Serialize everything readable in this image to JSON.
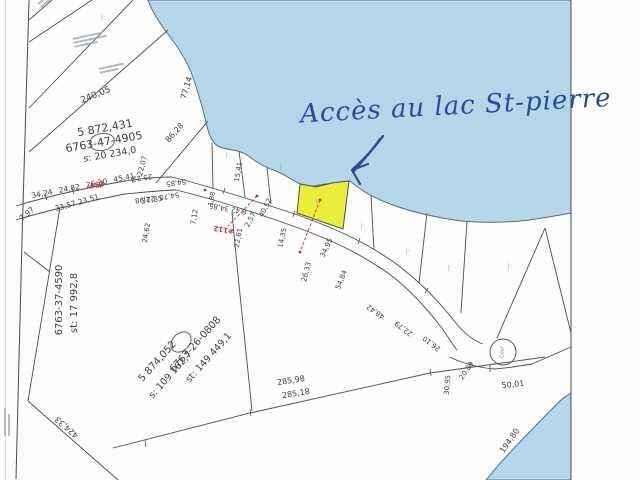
{
  "annotation": {
    "text": "Accès au lac St-pierre"
  },
  "colors": {
    "water": "#b5d6e9",
    "highlight": "#e9ed3c",
    "ink": "#2b4a9c",
    "red": "#d2293b",
    "line": "#474e57"
  },
  "marker_glyph": "∕·",
  "parcels": [
    {
      "number": "5 872,431",
      "id": "6763-47-4905",
      "area": "s: 20 234,0"
    },
    {
      "id": "6763-37-4590",
      "area": "st: 17 992,8"
    },
    {
      "number": "5 874,052",
      "area2": "s: 109 162,7",
      "id": "6763-26-0808",
      "area": "st: 149 449,1"
    }
  ],
  "road_refs": [
    "#53",
    "#112"
  ],
  "culdesac_label": "Cour",
  "labels": [
    {
      "t": "34,24 24,82 26,30 45,41",
      "x": 83,
      "y": 186,
      "r": -11,
      "s": 7.5,
      "ws": 4
    },
    {
      "t": "22,07",
      "x": 143,
      "y": 166,
      "r": -75,
      "s": 7
    },
    {
      "t": "25,22",
      "x": 142,
      "y": 177,
      "r": 172,
      "s": 7
    },
    {
      "t": "54,85",
      "x": 176,
      "y": 182,
      "r": 172,
      "s": 7
    },
    {
      "t": "54,70  22,98",
      "x": 157,
      "y": 197,
      "r": 172,
      "s": 7
    },
    {
      "t": "37,85",
      "x": 152,
      "y": 200,
      "r": -8,
      "s": 7.5
    },
    {
      "t": "33,57 23,51",
      "x": 77,
      "y": 203,
      "r": -16,
      "s": 7.5
    },
    {
      "t": "7,97",
      "x": 27,
      "y": 214,
      "r": -40,
      "s": 7.5
    },
    {
      "t": "24,62",
      "x": 147,
      "y": 233,
      "r": -80,
      "s": 7
    },
    {
      "t": "1,88",
      "x": 212,
      "y": 199,
      "r": -80,
      "s": 6.5
    },
    {
      "t": "7,12",
      "x": 195,
      "y": 217,
      "r": -80,
      "s": 7
    },
    {
      "t": "8,42 34,85",
      "x": 228,
      "y": 208,
      "r": 190,
      "s": 7
    },
    {
      "t": "40,52",
      "x": 266,
      "y": 208,
      "r": -62,
      "s": 7
    },
    {
      "t": "2,57",
      "x": 251,
      "y": 220,
      "r": -62,
      "s": 7
    },
    {
      "t": "22,61",
      "x": 239,
      "y": 238,
      "r": -80,
      "s": 7
    },
    {
      "t": "15,41",
      "x": 239,
      "y": 172,
      "r": -80,
      "s": 7
    },
    {
      "t": "14,35",
      "x": 283,
      "y": 238,
      "r": -78,
      "s": 7
    },
    {
      "t": "26,33",
      "x": 307,
      "y": 272,
      "r": -75,
      "s": 7
    },
    {
      "t": "34,95",
      "x": 327,
      "y": 248,
      "r": -65,
      "s": 7
    },
    {
      "t": "54,84",
      "x": 342,
      "y": 280,
      "r": -68,
      "s": 7
    },
    {
      "t": "48,42",
      "x": 376,
      "y": 311,
      "r": 215,
      "s": 7
    },
    {
      "t": "22,79",
      "x": 404,
      "y": 328,
      "r": 217,
      "s": 7
    },
    {
      "t": "26,10",
      "x": 432,
      "y": 343,
      "r": 218,
      "s": 7
    },
    {
      "t": "30,95",
      "x": 448,
      "y": 385,
      "r": -85,
      "s": 7
    },
    {
      "t": "20,89",
      "x": 467,
      "y": 371,
      "r": -55,
      "s": 7
    },
    {
      "t": "50,01",
      "x": 513,
      "y": 385,
      "r": -6,
      "s": 8
    },
    {
      "t": "285,98",
      "x": 291,
      "y": 381,
      "r": -9,
      "s": 8
    },
    {
      "t": "285,18",
      "x": 296,
      "y": 394,
      "r": -9,
      "s": 8
    },
    {
      "t": "424,33",
      "x": 67,
      "y": 427,
      "r": 221,
      "s": 8
    },
    {
      "t": "194,80",
      "x": 510,
      "y": 441,
      "r": -55,
      "s": 8
    },
    {
      "t": "240,05",
      "x": 96,
      "y": 96,
      "r": -22,
      "s": 9
    },
    {
      "t": "77,14",
      "x": 187,
      "y": 88,
      "r": -73,
      "s": 8
    },
    {
      "t": "86,28",
      "x": 175,
      "y": 133,
      "r": -48,
      "s": 8
    },
    {
      "t": "Cour",
      "x": 503,
      "y": 352,
      "r": -90,
      "s": 5,
      "c": "#7b8188",
      "n": "culdesac-label"
    },
    {
      "t": "5 872,431",
      "x": 105,
      "y": 128,
      "r": -10,
      "s": 11,
      "n": "parcel-number"
    },
    {
      "t": "6763-47-4905",
      "x": 104,
      "y": 142,
      "r": -10,
      "s": 11,
      "n": "parcel-id"
    },
    {
      "t": "s: 20 234,0",
      "x": 110,
      "y": 155,
      "r": -10,
      "s": 9.5,
      "n": "parcel-area"
    },
    {
      "t": "6763-37-4590",
      "x": 60,
      "y": 300,
      "r": -90,
      "s": 10,
      "n": "parcel-id"
    },
    {
      "t": "st: 17 992,8",
      "x": 75,
      "y": 303,
      "r": -90,
      "s": 10,
      "n": "parcel-area"
    },
    {
      "t": "5 874,052",
      "x": 158,
      "y": 362,
      "r": -48,
      "s": 10,
      "n": "parcel-number"
    },
    {
      "t": "s: 109 162,7",
      "x": 171,
      "y": 375,
      "r": -48,
      "s": 9.5,
      "n": "parcel-area"
    },
    {
      "t": "6763-26-0808",
      "x": 196,
      "y": 345,
      "r": -48,
      "s": 10,
      "n": "parcel-id"
    },
    {
      "t": "st: 149 449,1",
      "x": 209,
      "y": 358,
      "r": -48,
      "s": 9.5,
      "n": "parcel-area"
    },
    {
      "t": "#53",
      "x": 97,
      "y": 186,
      "r": -12,
      "s": 7,
      "c": "#d2293b",
      "w": 700,
      "n": "road-ref-label"
    },
    {
      "t": "#112",
      "x": 224,
      "y": 229,
      "r": 190,
      "s": 7,
      "c": "#d2293b",
      "w": 700,
      "n": "road-ref-label"
    }
  ],
  "markers": [
    [
      228,
      155
    ],
    [
      282,
      167
    ],
    [
      318,
      201
    ],
    [
      363,
      226
    ],
    [
      408,
      251
    ],
    [
      450,
      268
    ],
    [
      510,
      266
    ],
    [
      103,
      17
    ],
    [
      88,
      45
    ]
  ]
}
